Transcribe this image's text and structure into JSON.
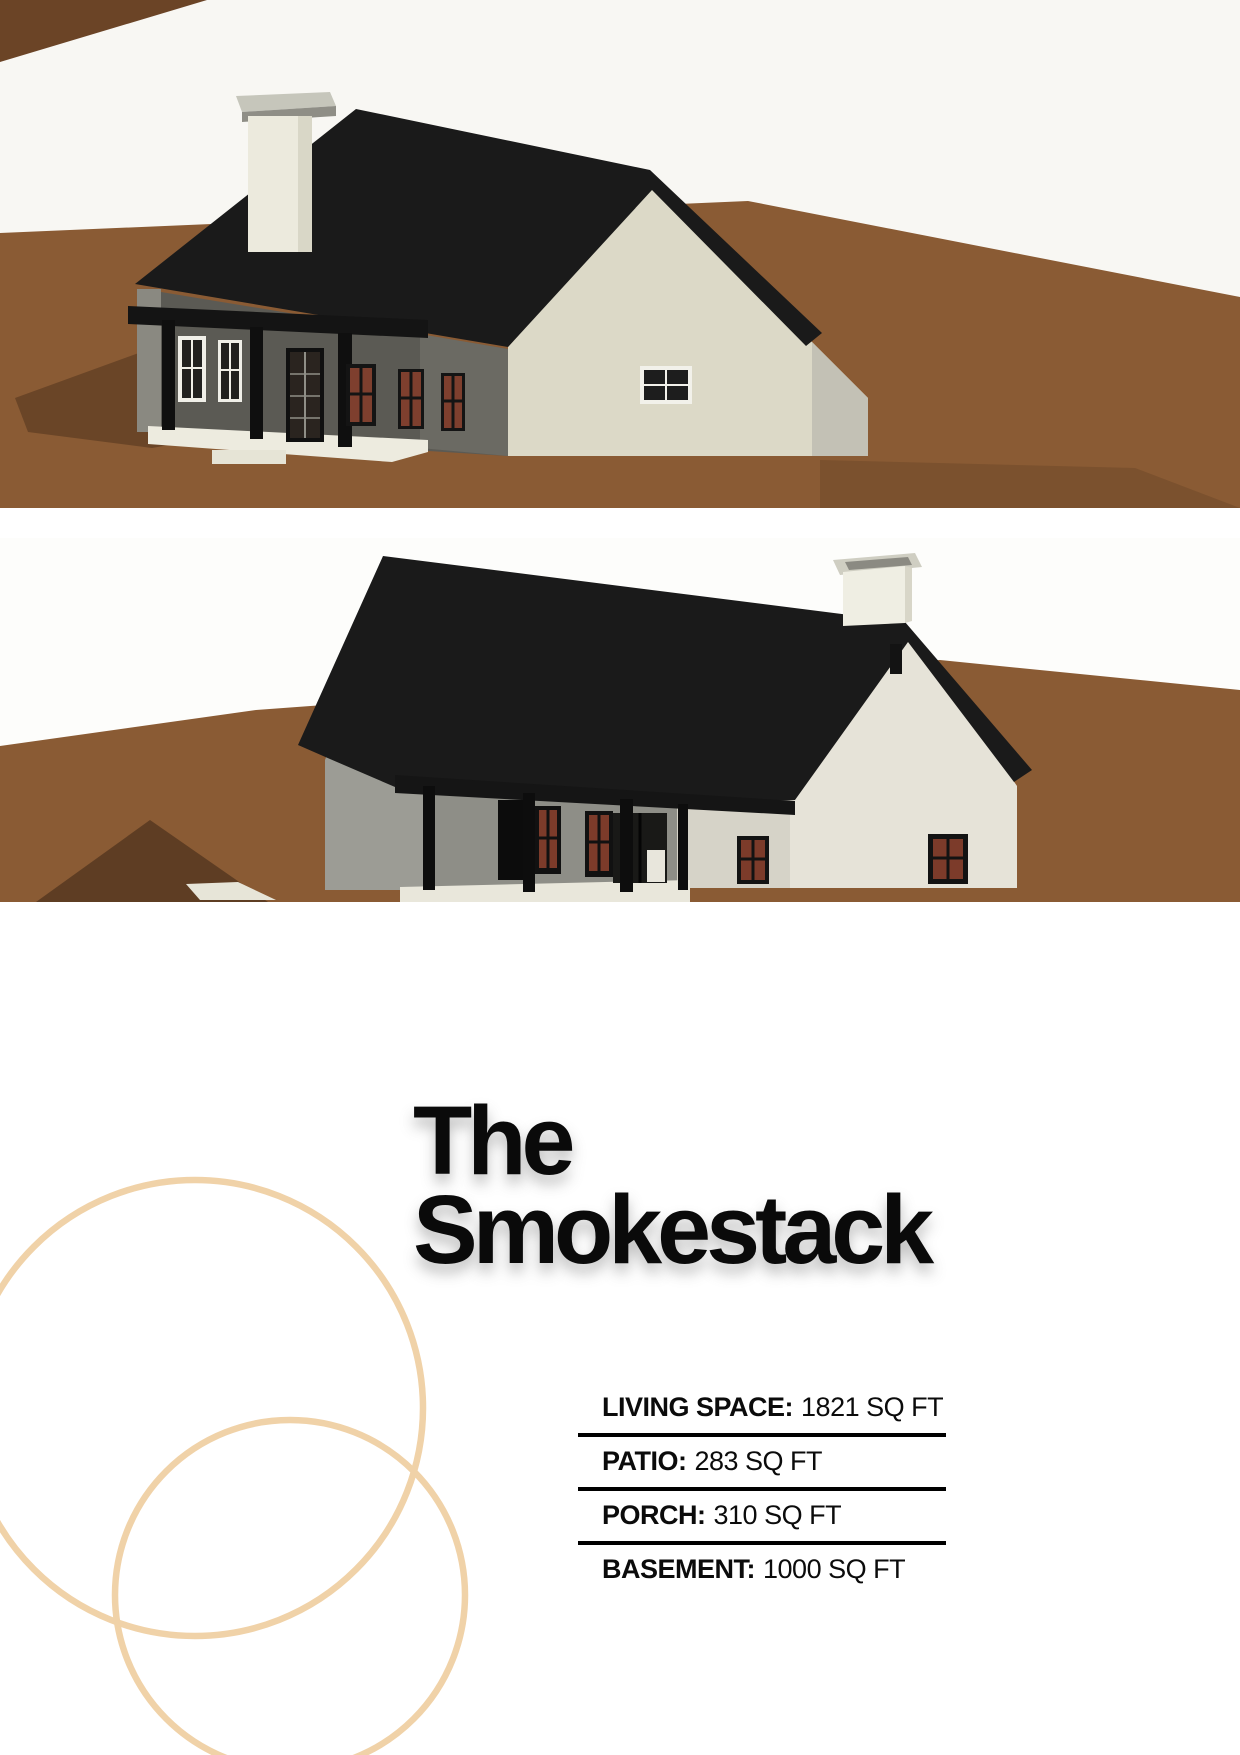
{
  "page": {
    "background": "#ffffff",
    "width": 1240,
    "height": 1755
  },
  "title": {
    "line1": "The",
    "line2": "Smokestack",
    "color": "#0a0a0a"
  },
  "specs": {
    "separator": ":",
    "rule_color": "#000000",
    "rows": [
      {
        "label": "LIVING SPACE",
        "value": "1821 SQ FT"
      },
      {
        "label": "PATIO",
        "value": "283 SQ FT"
      },
      {
        "label": "PORCH",
        "value": "310 SQ FT"
      },
      {
        "label": "BASEMENT",
        "value": "1000 SQ FT"
      }
    ]
  },
  "renders": [
    {
      "name": "house-render-rear-left",
      "description": "3D render of house with black gable roof, white chimney, covered porch, viewed from rear-left",
      "sky_color": "#f8f7f3",
      "ground_color": "#8a5b34",
      "roof_color": "#1a1a1a",
      "siding_color": "#dcd9c7",
      "shadow_color": "#6a4527",
      "window_pane_color": "#7e3f2e"
    },
    {
      "name": "house-render-front-right",
      "description": "3D render of same house viewed from front-right showing porch and chimney",
      "sky_color": "#fdfdfb",
      "ground_color": "#8a5b34",
      "roof_color": "#1a1a1a",
      "siding_color": "#e6e3d8",
      "shadow_color": "#5e3d23",
      "window_pane_color": "#7c3b2a"
    }
  ],
  "decor": {
    "circle_color": "#f0d2a8"
  }
}
